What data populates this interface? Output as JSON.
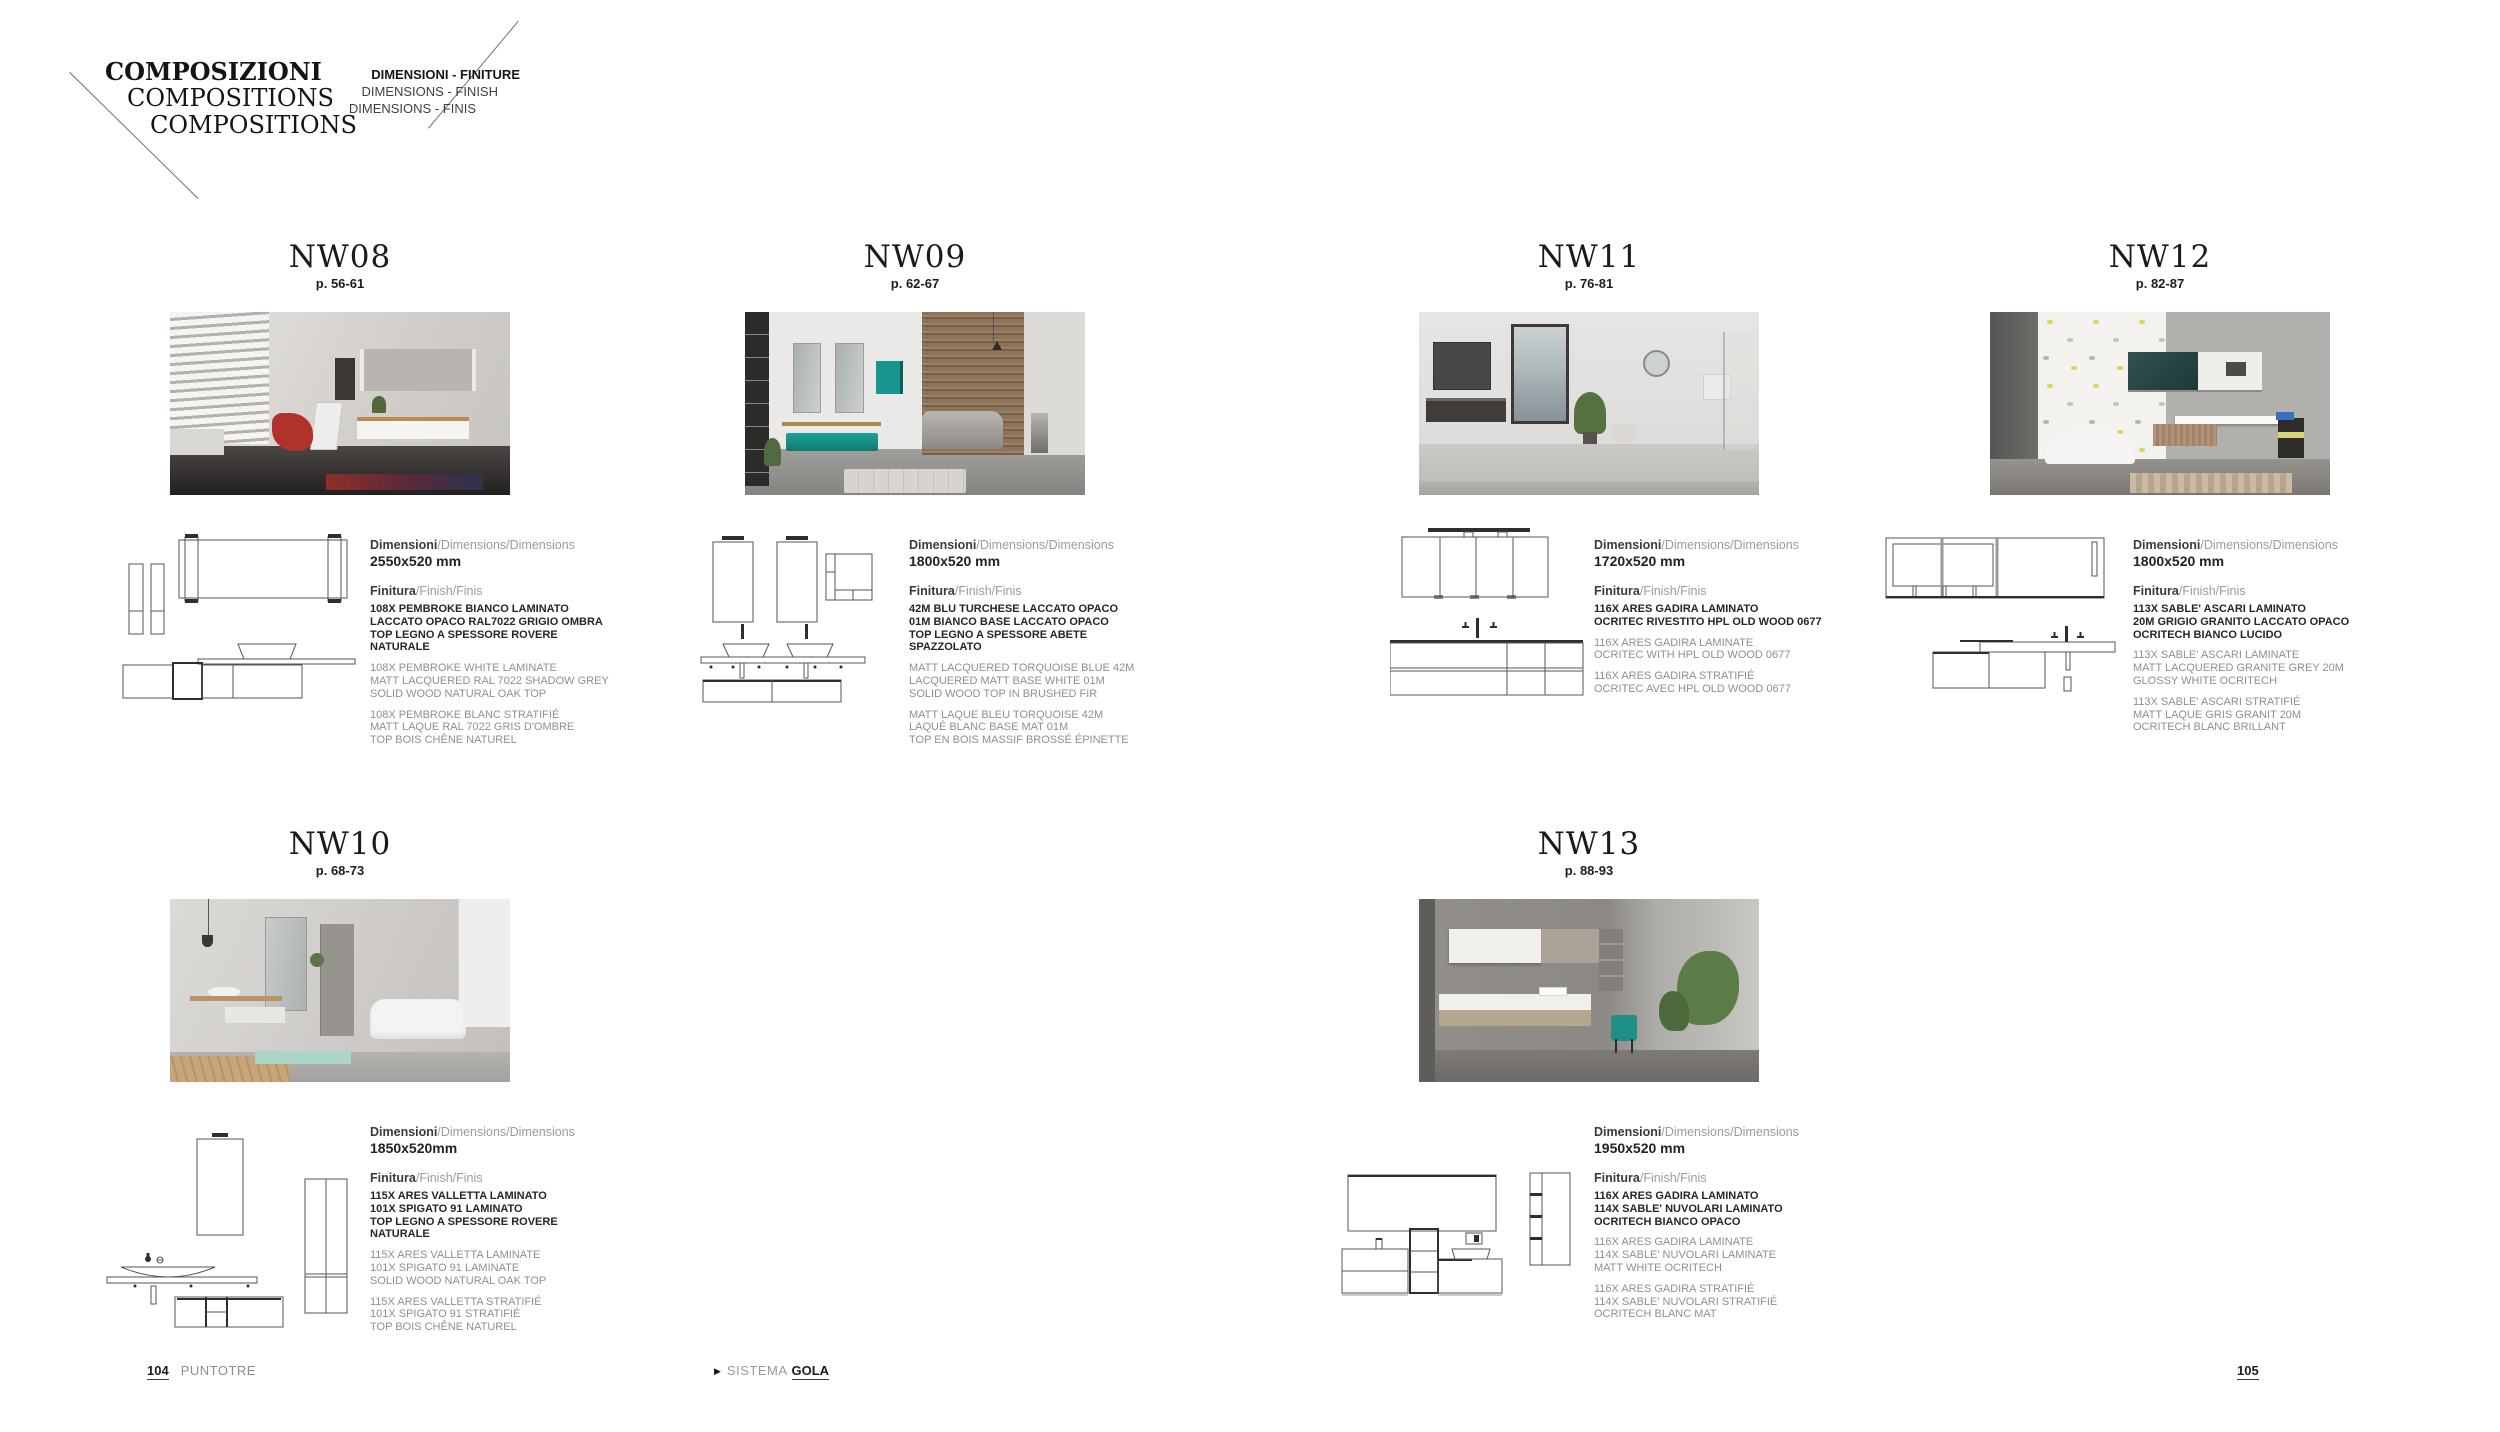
{
  "header": {
    "title_lines": [
      "COMPOSIZIONI",
      "COMPOSITIONS",
      "COMPOSITIONS"
    ],
    "subtitle_lines": [
      "DIMENSIONI - FINITURE",
      "DIMENSIONS - FINISH",
      "DIMENSIONS - FINIS"
    ]
  },
  "labels": {
    "dimensions_bold": "Dimensioni",
    "dimensions_rest": "/Dimensions/Dimensions",
    "finish_bold": "Finitura",
    "finish_rest": "/Finish/Finis"
  },
  "sections": [
    {
      "code": "NW08",
      "page_ref": "p. 56-61",
      "size": "2550x520 mm",
      "finish_it": [
        "108X PEMBROKE BIANCO LAMINATO",
        "LACCATO OPACO RAL7022 GRIGIO OMBRA",
        "TOP LEGNO A SPESSORE ROVERE NATURALE"
      ],
      "finish_en": [
        "108X PEMBROKE WHITE LAMINATE",
        "MATT LACQUERED RAL 7022 SHADOW GREY",
        "SOLID WOOD NATURAL OAK TOP"
      ],
      "finish_fr": [
        "108X PEMBROKE BLANC STRATIFIÉ",
        "MATT LAQUE RAL 7022 GRIS D'OMBRE",
        "TOP BOIS CHÊNE NATUREL"
      ]
    },
    {
      "code": "NW09",
      "page_ref": "p. 62-67",
      "size": "1800x520 mm",
      "finish_it": [
        "42M BLU TURCHESE LACCATO OPACO",
        "01M BIANCO BASE LACCATO OPACO",
        "TOP LEGNO A SPESSORE ABETE SPAZZOLATO"
      ],
      "finish_en": [
        "MATT LACQUERED TORQUOISE BLUE 42M",
        "LACQUERED MATT BASE WHITE 01M",
        "SOLID WOOD TOP IN BRUSHED FIR"
      ],
      "finish_fr": [
        "MATT LAQUE BLEU TORQUOISE 42M",
        "LAQUÉ BLANC BASE MAT 01M",
        "TOP EN BOIS MASSIF BROSSÉ ÉPINETTE"
      ]
    },
    {
      "code": "NW11",
      "page_ref": "p. 76-81",
      "size": "1720x520 mm",
      "finish_it": [
        "116X ARES GADIRA LAMINATO",
        "OCRITEC RIVESTITO HPL OLD WOOD 0677"
      ],
      "finish_en": [
        "116X ARES GADIRA LAMINATE",
        "OCRITEC WITH HPL OLD WOOD 0677"
      ],
      "finish_fr": [
        "116X ARES GADIRA STRATIFIÉ",
        "OCRITEC AVEC HPL OLD WOOD 0677"
      ]
    },
    {
      "code": "NW12",
      "page_ref": "p. 82-87",
      "size": "1800x520 mm",
      "finish_it": [
        "113X SABLE' ASCARI LAMINATO",
        "20M GRIGIO GRANITO LACCATO OPACO",
        "OCRITECH BIANCO LUCIDO"
      ],
      "finish_en": [
        "113X SABLE' ASCARI LAMINATE",
        "MATT LACQUERED GRANITE GREY 20M",
        "GLOSSY WHITE OCRITECH"
      ],
      "finish_fr": [
        "113X SABLE' ASCARI STRATIFIÉ",
        "MATT LAQUE GRIS GRANIT 20M",
        "OCRITECH BLANC BRILLANT"
      ]
    },
    {
      "code": "NW10",
      "page_ref": "p. 68-73",
      "size": "1850x520mm",
      "finish_it": [
        "115X ARES VALLETTA LAMINATO",
        "101X SPIGATO 91 LAMINATO",
        "TOP LEGNO A SPESSORE ROVERE NATURALE"
      ],
      "finish_en": [
        "115X ARES VALLETTA LAMINATE",
        "101X SPIGATO 91 LAMINATE",
        "SOLID WOOD NATURAL OAK TOP"
      ],
      "finish_fr": [
        "115X ARES VALLETTA STRATIFIÉ",
        "101X SPIGATO 91 STRATIFIÉ",
        "TOP BOIS CHÊNE NATUREL"
      ]
    },
    {
      "code": "NW13",
      "page_ref": "p. 88-93",
      "size": "1950x520 mm",
      "finish_it": [
        "116X ARES GADIRA LAMINATO",
        "114X SABLE' NUVOLARI LAMINATO",
        "OCRITECH BIANCO OPACO"
      ],
      "finish_en": [
        "116X ARES GADIRA LAMINATE",
        "114X SABLE' NUVOLARI LAMINATE",
        "MATT WHITE OCRITECH"
      ],
      "finish_fr": [
        "116X ARES GADIRA STRATIFIÉ",
        "114X SABLE' NUVOLARI STRATIFIÉ",
        "OCRITECH BLANC MAT"
      ]
    }
  ],
  "icons": {
    "arrow_right": "▶"
  },
  "footer": {
    "page_left": "104",
    "brand": "PUNTOTRE",
    "system_label": "SISTEMA",
    "system_name": "GOLA",
    "page_right": "105"
  }
}
